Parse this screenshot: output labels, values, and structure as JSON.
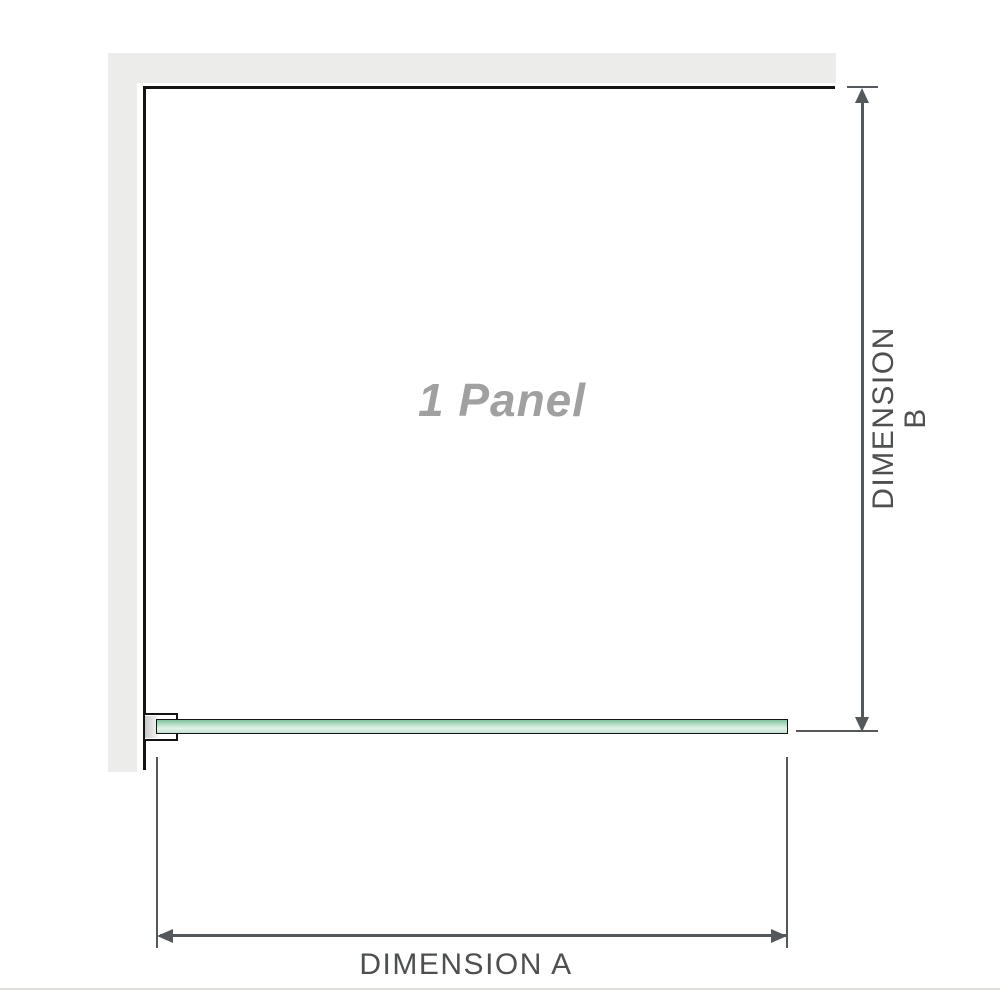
{
  "diagram": {
    "panel_label": "1 Panel",
    "dimension_a_label": "DIMENSION A",
    "dimension_b_label": "DIMENSION B"
  },
  "colors": {
    "wall": "#ececeb",
    "outline": "#141414",
    "dimension": "#55585a",
    "label_text": "#4d4f51",
    "panel_text": "#a0a0a0",
    "glass_dark": "#7ec19e",
    "glass_mid": "#b7dfca",
    "glass_light": "#e2f2e9",
    "glass_low": "#bfe2d0",
    "baseline": "#e0ded9"
  }
}
